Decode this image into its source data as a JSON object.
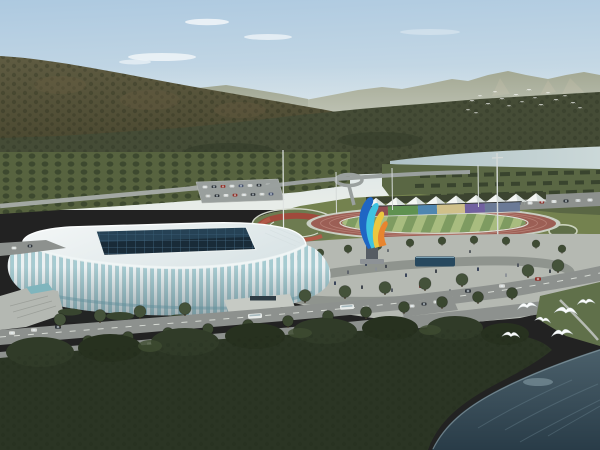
{
  "scene": {
    "type": "aerial-architectural-rendering",
    "subject": "riverside sports complex with glass arena, athletics track, event tents and lakeside forest",
    "time_of_day": "hazy daytime",
    "notable_objects": [
      "forested mountain ridge",
      "distant hazy hills",
      "river band behind complex",
      "white lattice-rib arena with dark glass skylight",
      "oval running track with striped infield",
      "row of white event tents",
      "multicolor banner wall",
      "feather-shaped colorful sculpture",
      "pedestrian plaza with reflecting pool",
      "tree-lined boulevards with cars and buses",
      "dark foreground woods",
      "lake in lower right",
      "white birds in flight"
    ]
  },
  "colors": {
    "sky_top": "#adc9e0",
    "sky_horizon": "#e7ece8",
    "far_mountain": "#a0a58f",
    "mid_ridge": "#949a83",
    "mountain_top": "#5f5c42",
    "mountain_bottom": "#49472f",
    "forest_band": "#454c36",
    "river_left": "#afc2c6",
    "river_right": "#cbd8d8",
    "orchard": "#57633f",
    "lawn": "#74824f",
    "track": "#9c5f55",
    "infield_light": "#a8bc7f",
    "infield_dark": "#7e9b61",
    "plaza": "#b5b9b2",
    "road": "#8d918e",
    "roof": "#f4f7f7",
    "stadium_rib": "#ebf1f2",
    "stadium_glass": "#a6cbd1",
    "skylight": "#192b38",
    "water_top": "#4b606b",
    "water_bottom": "#293c48",
    "foreground_trees": "#2b3524",
    "bird": "#fafcfc",
    "sculpture_blue": "#1f66c4",
    "sculpture_cyan": "#3fc3e0",
    "sculpture_yellow": "#ecc73f",
    "sculpture_orange": "#e8852f"
  },
  "banners": {
    "colors": [
      "#8f4f52",
      "#5f9150",
      "#4f86b0",
      "#cfc08a",
      "#71619f",
      "#6b7a96"
    ]
  },
  "counts": {
    "event_tents": 9,
    "banner_segments": 6,
    "foreground_birds": 6,
    "distant_flock_birds": 18,
    "floodlight_poles": 3
  }
}
